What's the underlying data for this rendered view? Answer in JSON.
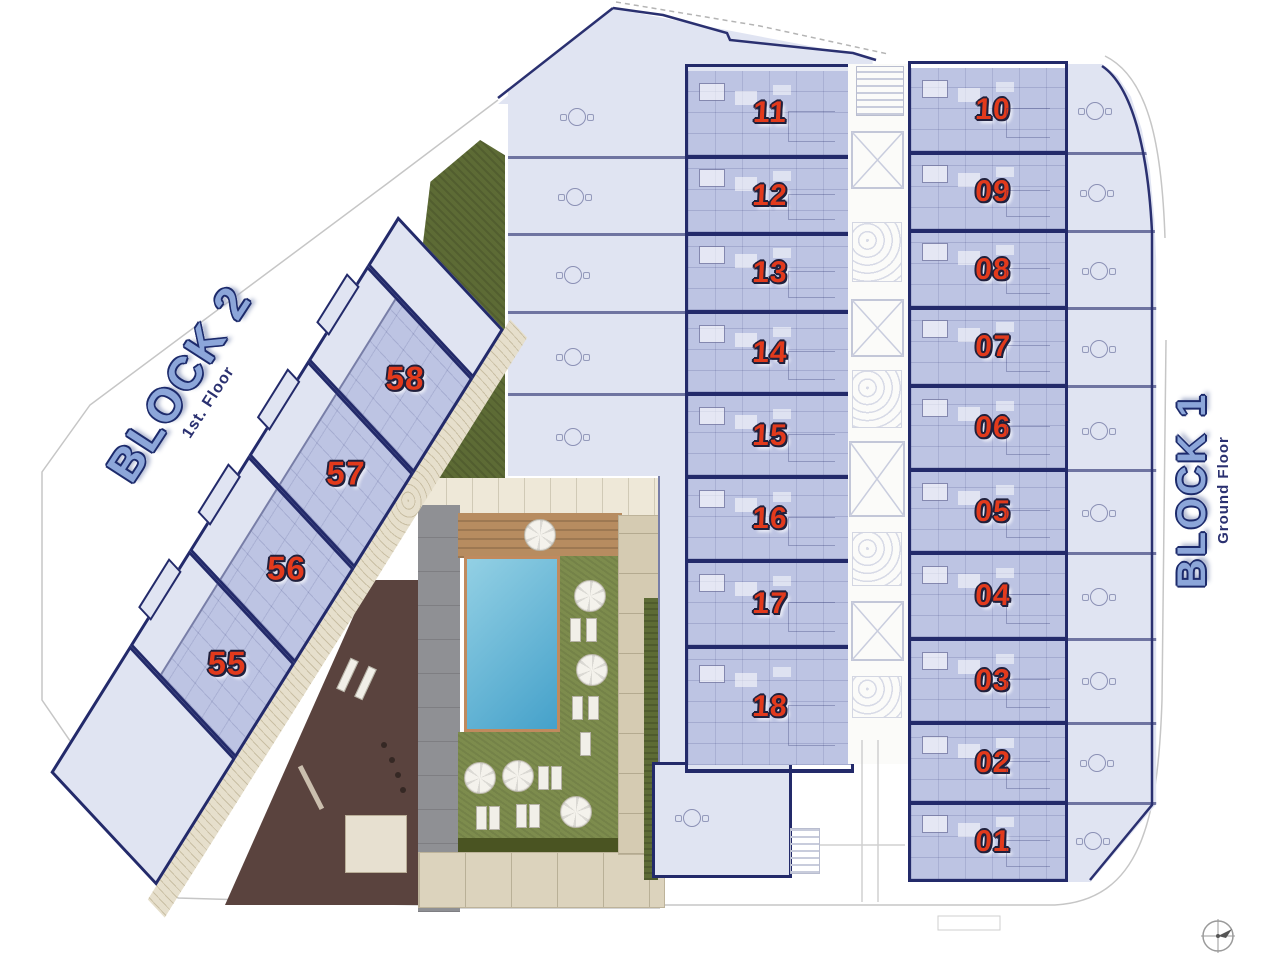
{
  "plan": {
    "block2": {
      "label": "BLOCK 2",
      "floor": "1st. Floor",
      "units": [
        "58",
        "57",
        "56",
        "55"
      ]
    },
    "block1": {
      "label": "BLOCK 1",
      "floor": "Ground Floor",
      "middle_units": [
        "11",
        "12",
        "13",
        "14",
        "15",
        "16",
        "17",
        "18"
      ],
      "right_units": [
        "10",
        "09",
        "08",
        "07",
        "06",
        "05",
        "04",
        "03",
        "02",
        "01"
      ]
    }
  },
  "icons": {
    "compass": "compass-rose",
    "umbrella": "parasol-top-view",
    "lounger": "sun-lounger-top-view",
    "elevator": "elevator-shaft-x",
    "stairs": "stair-hatch"
  },
  "colors": {
    "outline_navy": "#232a6a",
    "unit_fill": "#bdc4e3",
    "terrace_fill": "#e0e4f2",
    "number_red": "#e23a1c",
    "label_blue": "#8ca6d9",
    "pool_blue": "#45a1ca",
    "lawn_green": "#7d8c4d",
    "garden_green": "#5d6b35",
    "deck_brown": "#b78c60",
    "gym_brown": "#5a433e",
    "path_gray": "#8f9094",
    "stone_tan": "#dcd3bd"
  }
}
